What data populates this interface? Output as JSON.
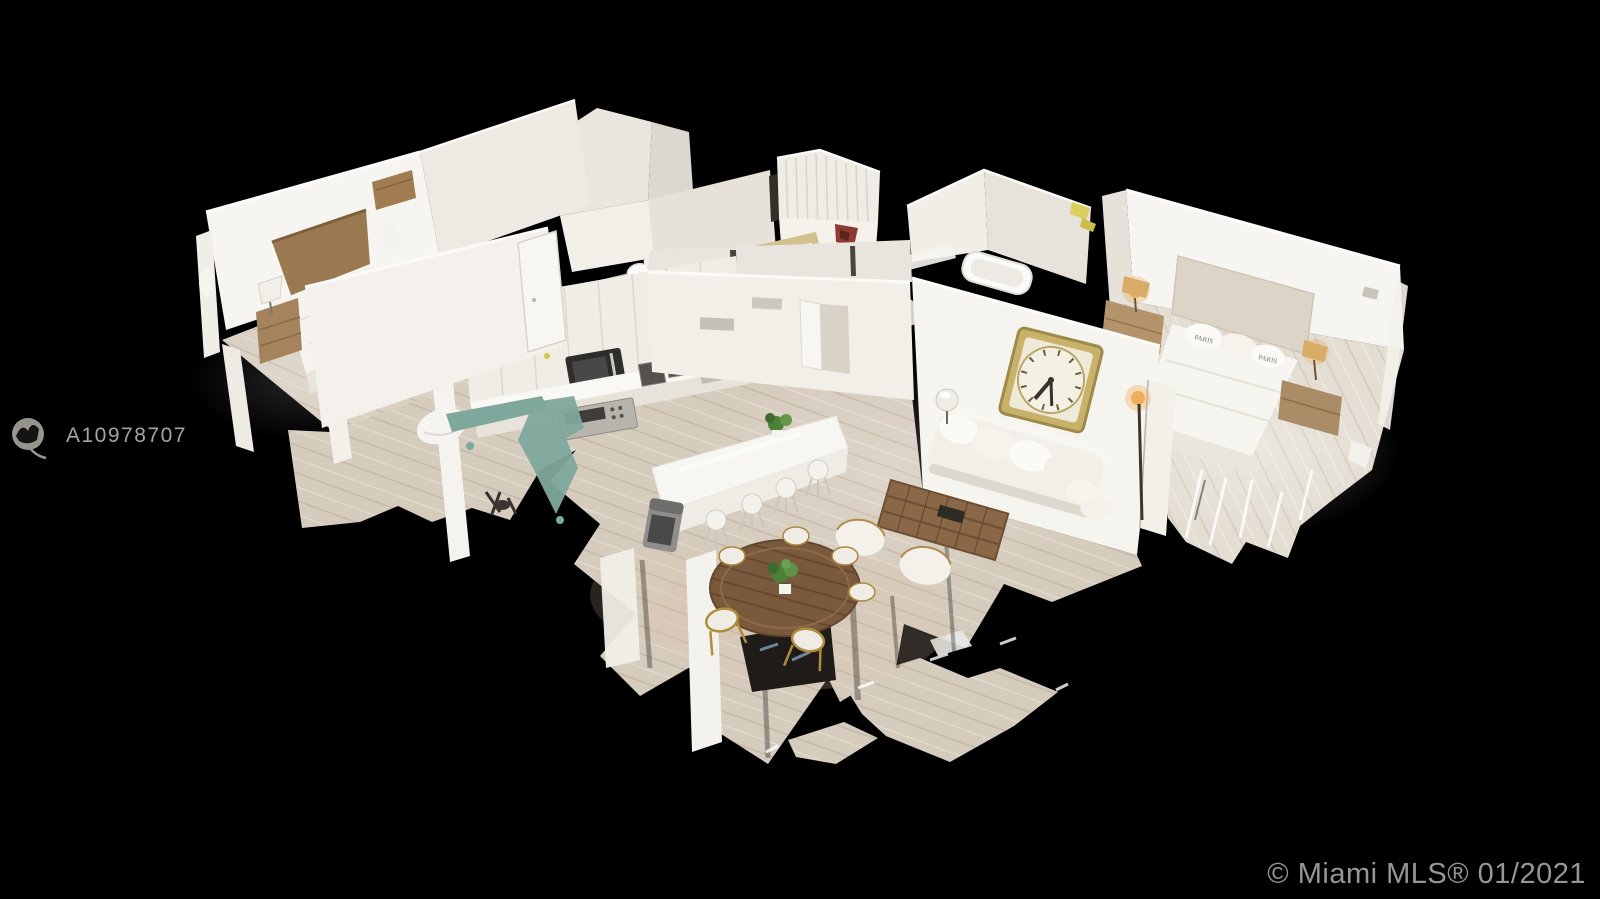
{
  "watermark": {
    "logo_icon": "mls-realtor-logo",
    "listing_id": "A10978707"
  },
  "footer": {
    "copyright": "© Miami MLS® 01/2021"
  },
  "scene": {
    "type": "3d-dollhouse-floorplan",
    "background": "#000000",
    "pillow_text": "PARIS",
    "palette": {
      "wall_bright": "#f6f4ef",
      "wall_mid": "#ece8e1",
      "wall_shaded": "#e0dcd4",
      "floor_wood": "#d6ccbe",
      "floor_master": "#e3ddd2",
      "plank_stripe": "#c4b8a6",
      "teal_artifact": "#7fa89d",
      "wood_headboard": "#9b7950",
      "wood_table": "#7a5a3d",
      "clock_frame": "#c8b269",
      "lamp_glow": "#eda64c",
      "clothes_red": "#8e3a31",
      "watermark_gray": "#a5a4a2"
    },
    "rooms": [
      "bedroom-left",
      "closet",
      "laundry",
      "bathroom",
      "hallway",
      "kitchen",
      "dining-area",
      "living-room",
      "master-bedroom",
      "master-bathroom"
    ],
    "objects": [
      "bed",
      "wood-headboard",
      "nightstand",
      "table-lamp",
      "dresser",
      "wardrobe-shelves",
      "toilet",
      "bathtub",
      "kitchen-cabinets",
      "microwave",
      "kitchen-sink",
      "kitchen-range",
      "kitchen-island",
      "bar-stools",
      "trash-can",
      "round-dining-table",
      "dining-chairs",
      "potted-plant",
      "armchairs",
      "coffee-table",
      "sofa",
      "wall-clock",
      "floor-lamp",
      "master-bed",
      "paris-pillows",
      "bedside-lamps",
      "scan-floor-fragments"
    ]
  }
}
